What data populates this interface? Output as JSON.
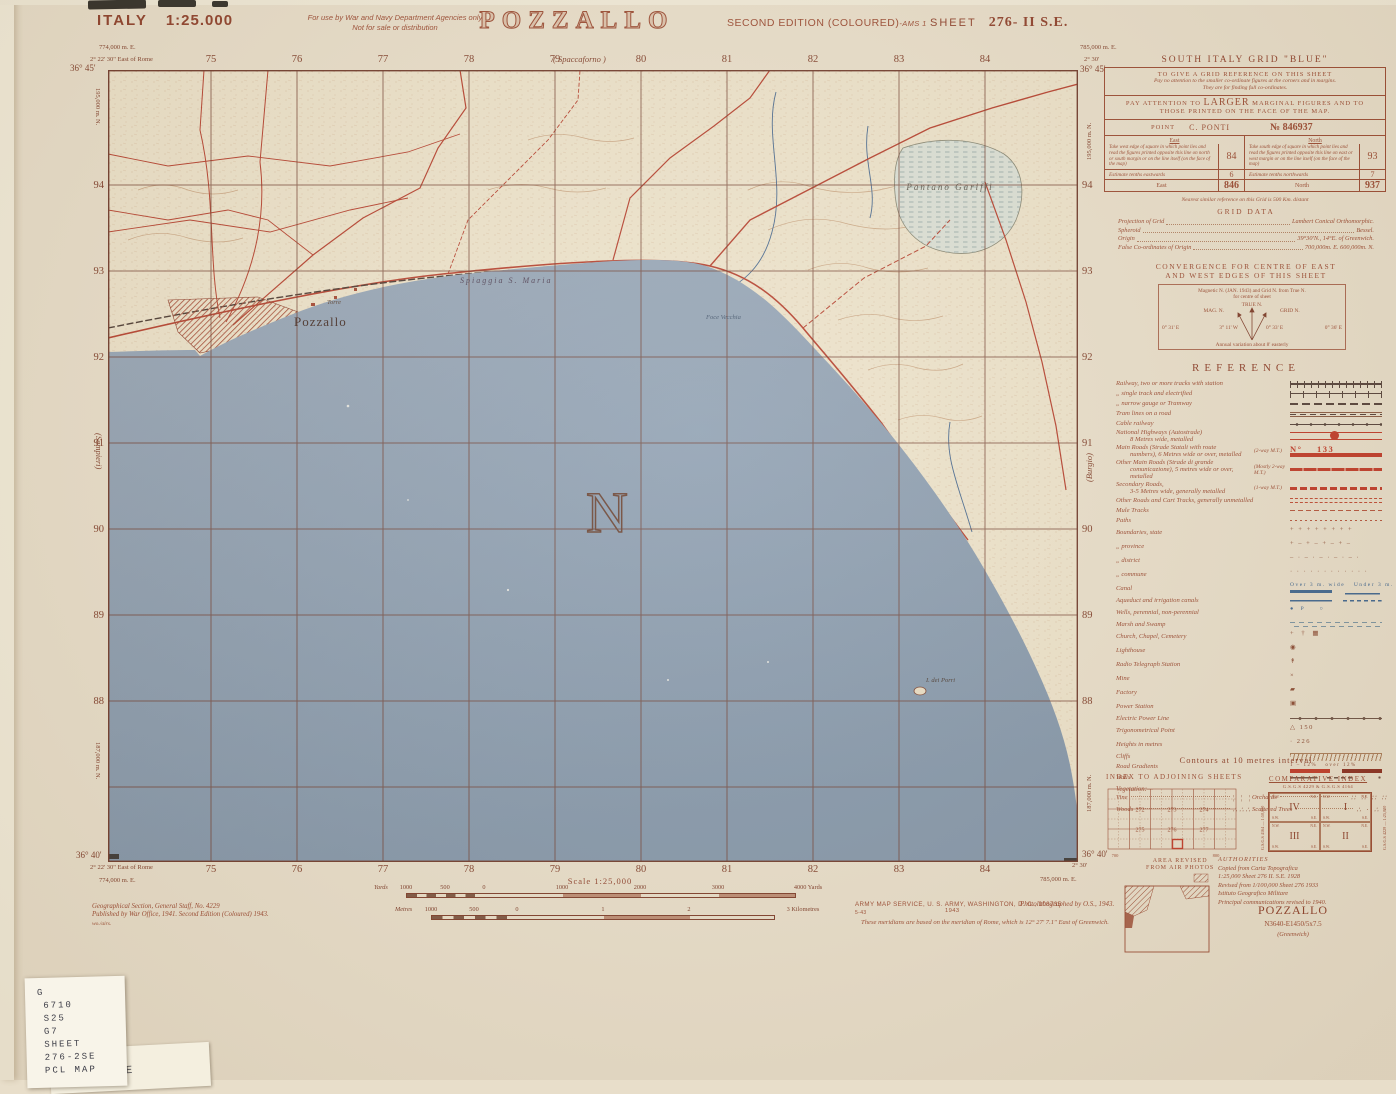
{
  "header": {
    "country": "ITALY",
    "scale": "1:25.000",
    "restriction1": "For use by War and Navy Department Agencies only",
    "restriction2": "Not for sale or distribution",
    "title": "POZZALLO",
    "edition": "SECOND EDITION (COLOURED)",
    "edition_suffix": "-AMS 1",
    "sheet_label": "SHEET",
    "sheet_number": "276- II  S.E."
  },
  "map": {
    "grid_cols": [
      "75",
      "76",
      "77",
      "78",
      "79",
      "80",
      "81",
      "82",
      "83",
      "84"
    ],
    "grid_rows": [
      "94",
      "93",
      "92",
      "91",
      "90",
      "89",
      "88"
    ],
    "top_left": {
      "easting": "774,000 m. E.",
      "lon": "2° 22' 30\" East of Rome",
      "lat": "36° 45'",
      "northing": "195,000 m. N."
    },
    "top_right": {
      "easting": "785,000 m. E.",
      "lon": "2° 30'",
      "lat": "36° 45'",
      "northing": "195,000 m. N."
    },
    "bottom_left": {
      "lat": "36° 40'",
      "lon": "2° 22' 30\" East of Rome",
      "easting": "774,000 m. E.",
      "northing": "187,000 m. N."
    },
    "bottom_right": {
      "lat": "36° 40'",
      "lon": "2° 30'",
      "easting": "785,000 m. E.",
      "northing": "187,000 m. N."
    },
    "edge_top": "( Spaccaforno )",
    "edge_left": "(Sampieri)",
    "edge_right": "(Burgio)",
    "labels": {
      "town": "Pozzallo",
      "torre": "Torre",
      "beach": "Spiaggia S. Maria",
      "marsh": "Pantano  Gariffi",
      "foce": "Foce Vecchia",
      "island": "I. dei Porri",
      "north": "N"
    }
  },
  "grid_ref_box": {
    "title": "SOUTH ITALY GRID \"BLUE\"",
    "s1a": "TO GIVE A GRID REFERENCE ON THIS SHEET",
    "s1b": "Pay no attention to the smaller co-ordinate figures at the corners and in margins.",
    "s1c": "They are for finding full co-ordinates.",
    "s2a": "PAY ATTENTION TO",
    "s2b": "LARGER",
    "s2c": "MARGINAL FIGURES AND TO",
    "s2d": "THOSE PRINTED ON THE FACE OF THE MAP.",
    "point_label": "POINT",
    "point_name": "C. PONTI",
    "point_ref": "№ 846937",
    "east_h": "East",
    "north_h": "North",
    "east_text": "Take west edge of square in which point lies and read the figures printed opposite this line on north or south margin or on the line itself (on the face of the map)",
    "north_text": "Take south edge of square in which point lies and read the figures printed opposite this line on east or west margin or on the line itself (on the face of the map)",
    "east_val": "84",
    "north_val": "93",
    "east_est": "Estimate tenths eastwards",
    "east_est_val": "6",
    "north_est": "Estimate tenths northwards",
    "north_est_val": "7",
    "east_total_label": "East",
    "east_total": "846",
    "north_total_label": "North",
    "north_total": "937",
    "note": "Nearest similar reference on this Grid is 500 Km. distant"
  },
  "grid_data": {
    "title": "GRID DATA",
    "rows": [
      {
        "label": "Projection of Grid",
        "value": "Lambert Conical Orthomorphic."
      },
      {
        "label": "Spheroid",
        "value": "Bessel."
      },
      {
        "label": "Origin",
        "value": "39°30'N., 14°E. of Greenwich."
      },
      {
        "label": "False Co-ordinates of Origin",
        "value": "700,000m. E.   600,000m. N."
      }
    ]
  },
  "convergence": {
    "title1": "CONVERGENCE FOR CENTRE OF EAST",
    "title2": "AND WEST EDGES OF THIS SHEET",
    "sub1": "Magnetic N. (JAN. 1943) and Grid N. from True N.",
    "sub2": "for centre of sheet",
    "true_n": "TRUE  N.",
    "mag_n": "MAG. N.",
    "grid_n": "GRID N.",
    "v_left": "0° 31' E",
    "v_mag": "3° 11' W",
    "v_grid": "0° 33' E",
    "v_right": "0° 36' E",
    "note": "Annual variation about 8' easterly"
  },
  "reference": {
    "title": "REFERENCE",
    "items": [
      {
        "label": "Railway, two or more tracks with station",
        "sym": "rail2"
      },
      {
        "label": "„       single track and electrified",
        "sym": "rail1"
      },
      {
        "label": "„       narrow gauge or Tramway",
        "sym": "railn"
      },
      {
        "label": "Tram lines on a road",
        "sym": "tram"
      },
      {
        "label": "Cable railway",
        "sym": "cable"
      },
      {
        "label": "National Highways (Autostrade)",
        "label2": "8 Metres wide, metalled",
        "sym": "autostrada"
      },
      {
        "label": "Main Roads (Strade Statali with route",
        "label2": "numbers), 6 Metres wide or over, metalled",
        "note": "(2-way M.T.)",
        "sym": "mainroad",
        "sym_text": "N°    133",
        "txtcls": "red"
      },
      {
        "label": "Other Main Roads (Strade di grande",
        "label2": "comunicazione), 5 metres wide or over, metalled",
        "note": "(Mostly 2-way M.T.)",
        "sym": "othermain"
      },
      {
        "label": "Secondary Roads,",
        "label2": "3-5 Metres wide, generally metalled",
        "note": "(1-way M.T.)",
        "sym": "secondary"
      },
      {
        "label": "Other Roads and Cart Tracks, generally unmetalled",
        "sym": "cart"
      },
      {
        "label": "Mule Tracks",
        "sym": "mule"
      },
      {
        "label": "Paths",
        "sym": "path"
      },
      {
        "label": "Boundaries, state",
        "sym_text": "+ + + + + + + +"
      },
      {
        "label": "„         province",
        "sym_text": "+ – + – + – + –"
      },
      {
        "label": "„         district",
        "sym_text": "– · – · – · – · – ·"
      },
      {
        "label": "„         commune",
        "sym_text": "· · · · · · · · · · · ·"
      },
      {
        "label": "Canal",
        "sym": "canal",
        "sym_text": "Over 3 m. wide   Under 3 m.",
        "txtcls": "blue"
      },
      {
        "label": "Aqueduct and irrigation canals",
        "sym": "aqueduct"
      },
      {
        "label": "Wells, perennial, non-perennial",
        "sym_text": "●  P     ○",
        "txtcls": "blue"
      },
      {
        "label": "Marsh and Swamp",
        "sym": "marsh"
      },
      {
        "label": "Church, Chapel, Cemetery",
        "sym_text": "+  †  ▦"
      },
      {
        "label": "Lighthouse",
        "sym_text": "◉"
      },
      {
        "label": "Radio Telegraph Station",
        "sym_text": "↟"
      },
      {
        "label": "Mine",
        "sym_text": "×"
      },
      {
        "label": "Factory",
        "sym_text": "▰"
      },
      {
        "label": "Power Station",
        "sym_text": "▣"
      },
      {
        "label": "Electric Power Line",
        "sym": "powerline"
      },
      {
        "label": "Trigonometrical Point",
        "sym_text": "△ 150"
      },
      {
        "label": "Heights in metres",
        "sym_text": "· 226"
      },
      {
        "label": "Cliffs",
        "sym": "cliffs"
      },
      {
        "label": "Road Gradients",
        "sym": "gradients",
        "sym_text": "1 – 12%   over 12%",
        "txtcls": "tiny"
      },
      {
        "label": "Walls",
        "sym": "walls"
      }
    ],
    "veg_title": "Vegetation:—",
    "veg": [
      {
        "label": "Vine",
        "sym_text": "¦ ¦ ¦"
      },
      {
        "label": "Orchards",
        "sym_text": "∷ ∷ ∷ ∷"
      },
      {
        "label": "Woods",
        "sym_text": "∴∴∴"
      },
      {
        "label": "Scattered Trees",
        "sym_text": "∴ · ∴ ·"
      }
    ],
    "contours": "Contours at 10 metres interval"
  },
  "adjoining": {
    "title": "INDEX TO ADJOINING SHEETS",
    "numbers": [
      "272",
      "273",
      "274",
      "275",
      "276",
      "277"
    ],
    "ticks": [
      "700",
      "800"
    ]
  },
  "comparative": {
    "title": "COMPARATIVE INDEX",
    "subtitle": "G.S.G.S 4229 & G.S.G.S 4164",
    "side_left": "G.S.G.S 4164 — 1:50,000",
    "side_right": "G.S.G.S 4229 — 1:25,000",
    "quadrants": [
      {
        "num": "IV",
        "nw": "N.W.",
        "ne": "N.E.",
        "sw": "S.W.",
        "se": "S.E."
      },
      {
        "num": "I",
        "nw": "N.W.",
        "ne": "N.E.",
        "sw": "S.W.",
        "se": "S.E."
      },
      {
        "num": "III",
        "nw": "N.W.",
        "ne": "N.E.",
        "sw": "S.W.",
        "se": "S.E."
      },
      {
        "num": "II",
        "nw": "N.W.",
        "ne": "N.E.",
        "sw": "S.W.",
        "se": "S.E."
      }
    ]
  },
  "revision": {
    "line1": "AREA REVISED",
    "line2": "FROM AIR PHOTOS"
  },
  "authorities": {
    "title": "AUTHORITIES",
    "lines": [
      "Copied from Carta Topografica",
      "1:25,000 Sheet 276  II. S.E. 1928",
      "Revised from 1/100,000 Sheet 276  1933",
      "Istituto Geografico Militare",
      "Principal communications revised to 1940."
    ],
    "name": "POZZALLO",
    "ref": "N3640-E1450/5x7.5",
    "greenwich": "(Greenwich)"
  },
  "footer": {
    "scale_title": "Scale 1:25,000",
    "yards_unit": "Yards",
    "yards_labels": [
      "1000",
      "500",
      "0",
      "1000",
      "2000",
      "3000"
    ],
    "yards_end": "4000 Yards",
    "metres_unit": "Metres",
    "metres_labels": [
      "1000",
      "500",
      "0",
      "1",
      "2"
    ],
    "metres_end": "3 Kilometres",
    "publisher1": "Geographical Section, General Staff, No. 4229",
    "publisher2": "Published by War Office, 1941. Second Edition (Coloured) 1943.",
    "publisher3": "wo./airs.",
    "ams": "ARMY MAP SERVICE, U. S. ARMY, WASHINGTON, D. C., 108735",
    "ams_year": "1943",
    "ams_code": "5-43",
    "photolith": "Photolithographed by O.S., 1943.",
    "meridian_note": "These meridians are based on the meridian of Rome, which is 12° 27' 7.1\" East of Greenwich."
  },
  "sticker": {
    "lines": [
      "G",
      "6710",
      "S25",
      "G7",
      "SHEET",
      "276-2SE",
      "PCL MAP"
    ]
  },
  "sticker2": {
    "text": "276-2SE"
  }
}
